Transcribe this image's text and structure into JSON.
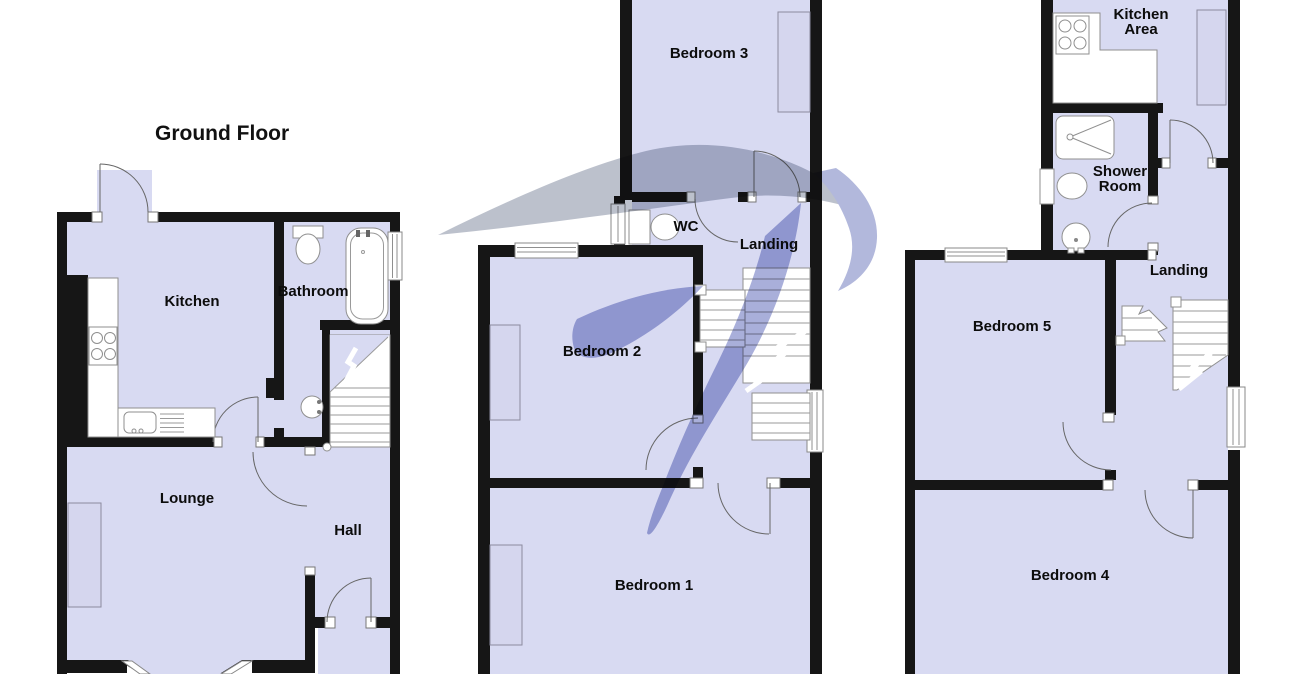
{
  "palette": {
    "background": "#ffffff",
    "wall": "#161616",
    "floor_fill": "#d8daf2",
    "furniture_fill": "#d5d6ee",
    "fixture_outline": "#8f8f8f",
    "watermark_gray": "#b5bac7",
    "watermark_purple": "#a0a6d6"
  },
  "ground_floor": {
    "title": "Ground Floor",
    "rooms": {
      "kitchen": "Kitchen",
      "bathroom": "Bathroom",
      "lounge": "Lounge",
      "hall": "Hall"
    }
  },
  "first_floor": {
    "rooms": {
      "bedroom3": "Bedroom 3",
      "wc": "WC",
      "landing": "Landing",
      "bedroom2": "Bedroom 2",
      "bedroom1": "Bedroom 1"
    }
  },
  "second_floor": {
    "rooms": {
      "kitchen_area": [
        "Kitchen",
        "Area"
      ],
      "shower_room": [
        "Shower",
        "Room"
      ],
      "landing": "Landing",
      "bedroom5": "Bedroom 5",
      "bedroom4": "Bedroom 4"
    }
  }
}
